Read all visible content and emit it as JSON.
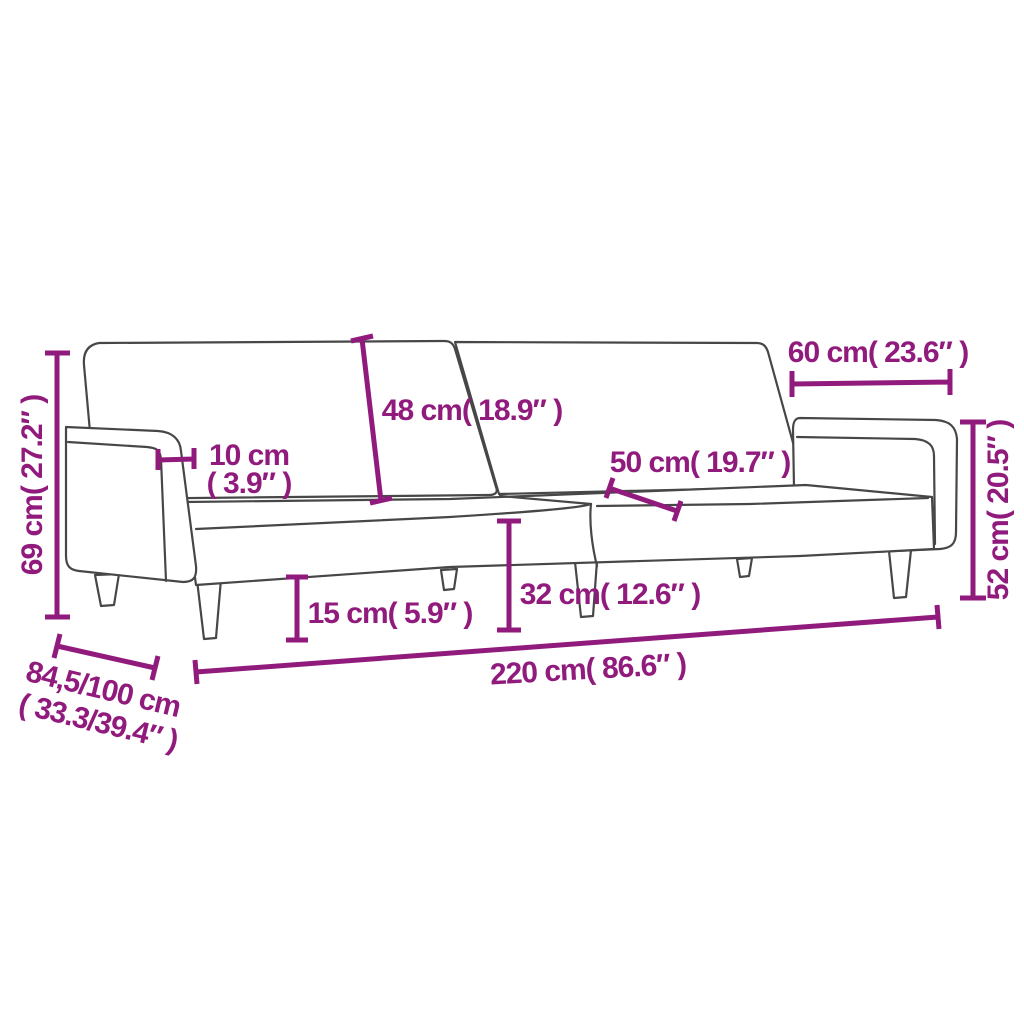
{
  "diagram": {
    "kind": "product-dimension-diagram",
    "subject": "two-seater sofa bed line drawing with dimension callouts",
    "background_color": "#ffffff",
    "outline_color": "#474747",
    "accent_color": "#911b7d"
  },
  "dims": {
    "total_height": {
      "label": "69 cm( 27.2″ )"
    },
    "armrest_width": {
      "line1": "10 cm",
      "line2": "( 3.9″ )"
    },
    "backrest_height": {
      "label": "48 cm( 18.9″ )"
    },
    "armrest_length": {
      "label": "60 cm( 23.6″ )"
    },
    "seat_depth": {
      "label": "50 cm( 19.7″ )"
    },
    "armrest_height": {
      "label": "52 cm( 20.5″ )"
    },
    "seat_height": {
      "label": "32 cm( 12.6″ )"
    },
    "leg_height": {
      "label": "15 cm( 5.9″ )"
    },
    "total_length": {
      "label": "220 cm( 86.6″ )"
    },
    "depth_range": {
      "line1": "84,5/100 cm",
      "line2": "( 33.3/39.4″ )"
    }
  }
}
